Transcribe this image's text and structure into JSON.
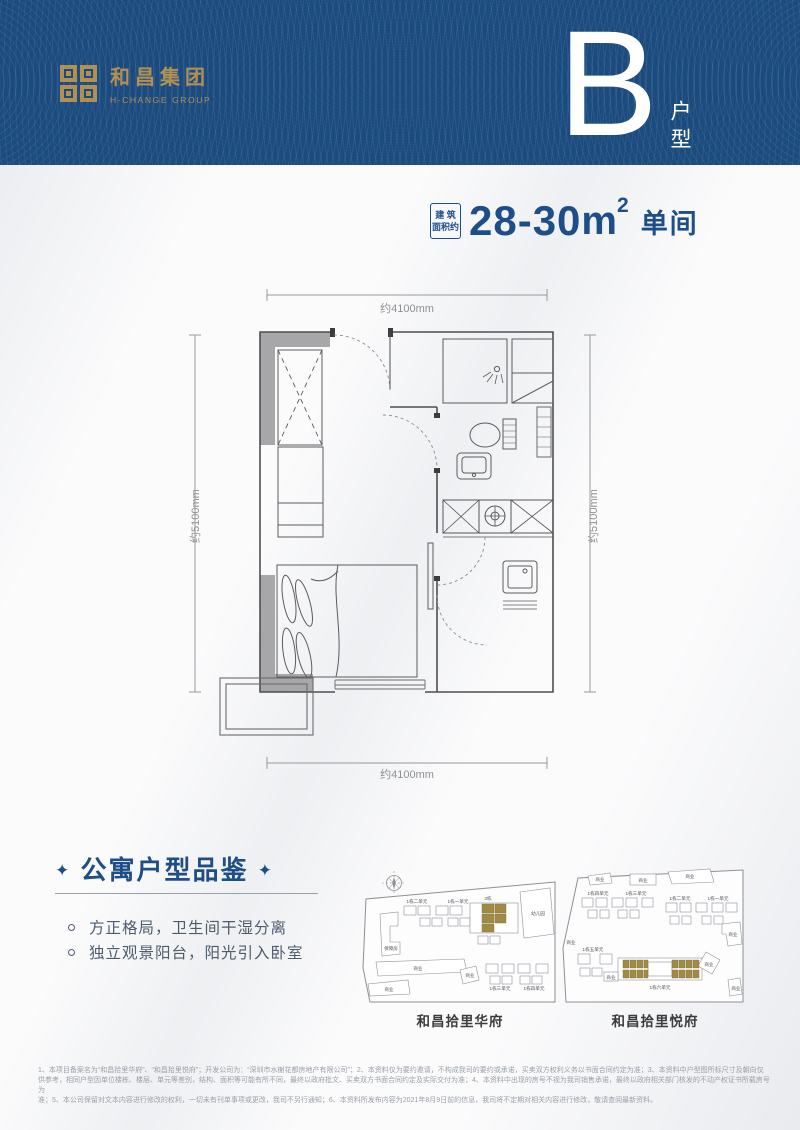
{
  "header": {
    "brand_cn": "和昌集团",
    "brand_en": "H-CHANGE GROUP",
    "unit_letter": "B",
    "unit_suffix": "户型"
  },
  "title": {
    "tag_line1": "建 筑",
    "tag_line2": "面积约",
    "area": "28-30",
    "area_unit": "m",
    "area_sup": "2",
    "room_type": "单间"
  },
  "plan": {
    "dim_top": "约4100mm",
    "dim_bottom": "约4100mm",
    "dim_left": "约5100mm",
    "dim_right": "约5100mm"
  },
  "features": {
    "star": "✦",
    "title": "公寓户型品鉴",
    "items": [
      "方正格局，卫生间干湿分离",
      "独立观景阳台，阳光引入卧室"
    ]
  },
  "maps": {
    "huafu": {
      "name": "和昌拾里华府",
      "labels": {
        "unit2": "1栋二单元",
        "unit1": "1栋一单元",
        "block3": "3栋",
        "unit3": "1栋三单元",
        "unit4": "1栋四单元",
        "kindergarten": "幼儿园",
        "affordable": "保障房",
        "biz": "商业"
      }
    },
    "yuefu": {
      "name": "和昌拾里悦府",
      "labels": {
        "unit1": "1栋一单元",
        "unit2": "1栋二单元",
        "unit3": "1栋三单元",
        "unit4": "1栋四单元",
        "unit5": "1栋五单元",
        "unit6": "1栋六单元",
        "biz": "商业"
      }
    }
  },
  "footnotes": [
    "1、本项目备案名为“和昌拾里华府”、“和昌拾里悦府”；开发公司为：“深圳市水榭花都房地产有限公司”；2、本资料仅为要约邀请，不构成我司的要约或承诺，买卖双方权利义务以书面合同约定为准；3、本资料中户型图所标尺寸及朝向仅",
    "供参考，相同户型因单位楼栋、楼层、单元等差别，结构、面积等可能有所不同，最终以政府批文、买卖双方书面合同约定及实际交付为准；4、本资料中出现的房号不视为我司销售承诺，最终以政府相关部门核发的不动产权证书所载房号为",
    "准；5、本公司保留对文本内容进行修改的权利，一切未有刊单事项或更改，我司不另行通知；6、本资料所发布内容为2021年8月9日前的信息，我司将不定期对相关内容进行修改，敬请查阅最新资料。"
  ],
  "colors": {
    "header_bg": "#1b4a7d",
    "gold": "#b29054",
    "navy": "#1d4e88",
    "map_highlight": "#a18a45"
  }
}
